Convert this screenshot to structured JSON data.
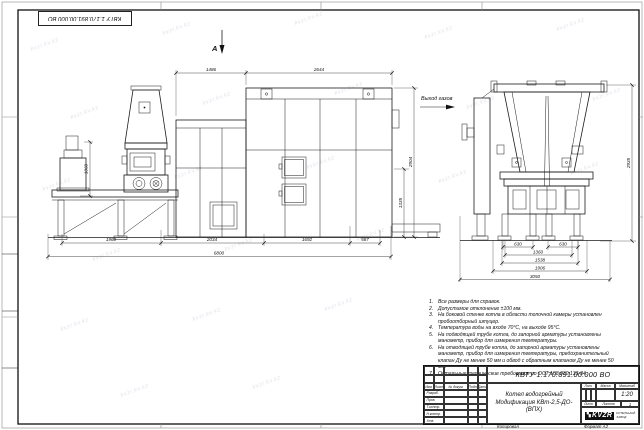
{
  "sheet": {
    "watermark_text": "kvzr.kv.kz",
    "doc_number_top": "КВТУ 1.170.891.00.000 ВО",
    "copied_label": "Копировал",
    "format_label": "Формат А2"
  },
  "drawing": {
    "view_arrow_label": "А",
    "gas_outlet_label": "Выход газов",
    "dims": {
      "w1": "1486",
      "w2": "2644",
      "b1": "1960",
      "b2": "2034",
      "b3": "1692",
      "b4": "587",
      "overall_width": "6800",
      "h_pedestal": "1060",
      "h_lower": "1335",
      "h_boiler": "2904",
      "h_end": "2935",
      "e1": "630",
      "e2": "630",
      "e3": "1360",
      "e4": "1538",
      "e5": "1906",
      "e_overall": "3050"
    }
  },
  "notes": {
    "items": [
      {
        "num": "1.",
        "text": "Все размеры для справок."
      },
      {
        "num": "2.",
        "text": "Допустимое отклонение ±100 мм."
      },
      {
        "num": "3.",
        "text": "На боковой стенке котла в области топочной камеры установлен пробоотборный штуцер."
      },
      {
        "num": "4.",
        "text": "Температура воды на входе 70°С, на выходе 95°С."
      },
      {
        "num": "5.",
        "text": "На подводящей трубе котла, до запорной арматуры установлены манометр, прибор для измерения температуры."
      },
      {
        "num": "6.",
        "text": "На отводящей трубе котла, до запорной арматуры установлены манометр, прибор для измерения температуры, предохранительный клапан Ду не менее 50 мм и обвод с обратным клапаном Ду не менее 50 мм."
      },
      {
        "num": "7.",
        "text": "Остальные технические требования по ОСТ 108.030.133-84."
      }
    ]
  },
  "title_block": {
    "doc_number": "КВТУ 1.170.891.00.000 ВО",
    "product_name_line1": "Котел водогрейный",
    "product_name_line2": "Модификация КВт-2,5-ДО-(ВПХ)",
    "cols": {
      "izm": "Изм.",
      "list": "Лист",
      "doc": "№ докум.",
      "podp": "Подп.",
      "data": "Дата"
    },
    "rows": {
      "razrab": "Разраб.",
      "prov": "Пров.",
      "tkontr": "Т.контр.",
      "nkontr": "Н.контр.",
      "utv": "Утв."
    },
    "lit_label": "Лит.",
    "mass_label": "Масса",
    "scale_label": "Масштаб",
    "scale_value": "1:20",
    "sheet_label": "Лист",
    "sheets_label": "Листов",
    "sheets_value": "1",
    "company": {
      "logo": "KVZR",
      "line1": "КОТЕЛЬНЫЙ",
      "line2": "ЗАВОД"
    }
  }
}
